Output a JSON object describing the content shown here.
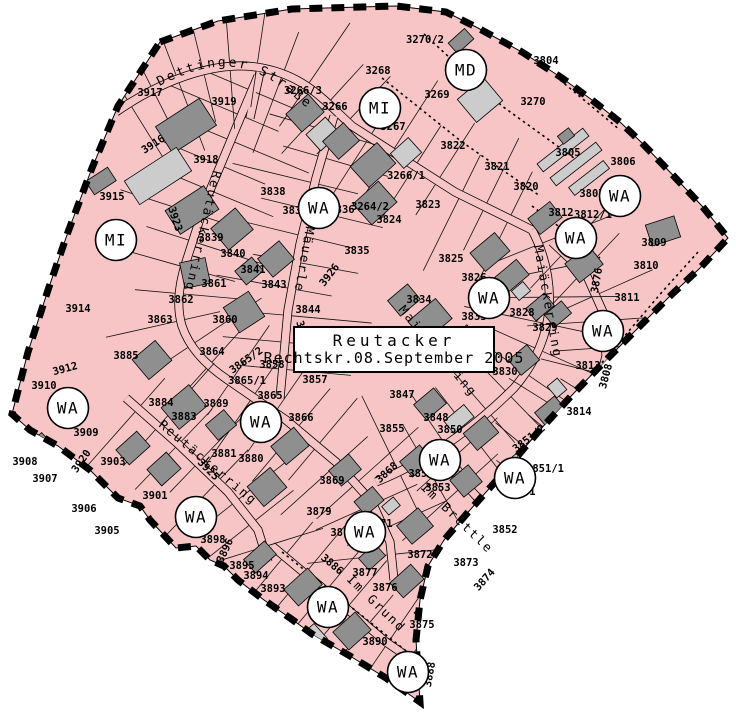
{
  "map": {
    "width": 736,
    "height": 724,
    "kind": "zoning-plan"
  },
  "colors": {
    "zone_pink": "#f7c5c5",
    "building_dark": "#8f8f8f",
    "building_light": "#cccccc",
    "line": "#000000",
    "background": "#ffffff",
    "circle_fill": "#ffffff"
  },
  "title_box": {
    "line1": "Reutacker",
    "line2": "Rechtskr.08.September  2005"
  },
  "boundary": [
    [
      160,
      42
    ],
    [
      218,
      21
    ],
    [
      292,
      9
    ],
    [
      396,
      6
    ],
    [
      446,
      12
    ],
    [
      478,
      28
    ],
    [
      522,
      52
    ],
    [
      562,
      78
    ],
    [
      592,
      100
    ],
    [
      620,
      122
    ],
    [
      642,
      143
    ],
    [
      668,
      170
    ],
    [
      702,
      206
    ],
    [
      728,
      238
    ],
    [
      700,
      268
    ],
    [
      668,
      298
    ],
    [
      640,
      326
    ],
    [
      610,
      356
    ],
    [
      574,
      393
    ],
    [
      538,
      432
    ],
    [
      504,
      472
    ],
    [
      470,
      510
    ],
    [
      444,
      540
    ],
    [
      428,
      566
    ],
    [
      420,
      600
    ],
    [
      416,
      640
    ],
    [
      420,
      702
    ],
    [
      386,
      678
    ],
    [
      350,
      656
    ],
    [
      312,
      634
    ],
    [
      290,
      618
    ],
    [
      264,
      600
    ],
    [
      238,
      580
    ],
    [
      224,
      566
    ],
    [
      210,
      560
    ],
    [
      196,
      546
    ],
    [
      176,
      548
    ],
    [
      150,
      520
    ],
    [
      140,
      506
    ],
    [
      118,
      498
    ],
    [
      90,
      470
    ],
    [
      58,
      446
    ],
    [
      30,
      430
    ],
    [
      12,
      414
    ],
    [
      28,
      352
    ],
    [
      48,
      290
    ],
    [
      68,
      232
    ],
    [
      92,
      168
    ],
    [
      118,
      106
    ]
  ],
  "roads": [
    {
      "id": "dettinger-strasse",
      "d": "M116,112 C168,76 222,60 262,68 C304,76 322,98 352,126 L455,192 L532,230",
      "ticks": true
    },
    {
      "id": "reutaeckerring-upper",
      "d": "M258,76 L236,128 L206,200 L186,262 Q174,300 182,326 Q192,356 228,380 L286,420 L336,462 L372,502 L390,542 L394,580",
      "ticks": true
    },
    {
      "id": "reutaeckerring-lower",
      "d": "M126,398 L178,444 L228,492 L258,530 L268,562",
      "ticks": true
    },
    {
      "id": "maiaeckerring",
      "d": "M532,230 Q552,268 549,310 Q545,352 514,388 Q478,424 438,450 Q406,470 376,482",
      "ticks": true
    },
    {
      "id": "im-maeuerle",
      "d": "M334,116 L316,178 L300,244 L288,310 L280,398",
      "ticks": true
    },
    {
      "id": "im-brettle",
      "d": "M436,452 L476,496 L514,540 L540,566",
      "ticks": true
    },
    {
      "id": "im-grund",
      "d": "M272,546 Q330,594 386,642 L430,672",
      "ticks": true
    },
    {
      "id": "east-lane",
      "d": "M552,242 L586,274 L603,312 L606,356 L595,400 L570,440 L542,474 L522,500",
      "ticks": true
    },
    {
      "id": "north-spur",
      "d": "M260,72 L250,118",
      "ticks": false
    }
  ],
  "dotted_lines": [
    "M382,78 L462,142 L540,196",
    "M424,34 L502,106 L574,158",
    "M532,206 L600,258",
    "M698,252 L662,292 L560,412 L434,574 L424,640",
    "M282,552 L420,662",
    "M560,80 L620,130"
  ],
  "street_labels": {
    "curved": {
      "text": "Dettinger Straße",
      "path": "M156,88 C215,56 252,58 302,104 L336,128",
      "size": 13
    },
    "straight": [
      {
        "text": "Reutäckerring",
        "x": 213,
        "y": 170,
        "rot": 103
      },
      {
        "text": "Reutäckerring",
        "x": 158,
        "y": 426,
        "rot": 40
      },
      {
        "text": "Im Mäuerle",
        "x": 311,
        "y": 198,
        "rot": 100
      },
      {
        "text": "Maiäckerring",
        "x": 534,
        "y": 246,
        "rot": 80
      },
      {
        "text": "Maiäckerring",
        "x": 398,
        "y": 310,
        "rot": 50
      },
      {
        "text": "Im Brettle",
        "x": 420,
        "y": 488,
        "rot": 44
      },
      {
        "text": "Im Grund",
        "x": 346,
        "y": 580,
        "rot": 44
      }
    ]
  },
  "zone_circles": [
    {
      "label": "MD",
      "x": 466,
      "y": 70
    },
    {
      "label": "MI",
      "x": 380,
      "y": 108
    },
    {
      "label": "MI",
      "x": 116,
      "y": 240
    },
    {
      "label": "WA",
      "x": 319,
      "y": 208
    },
    {
      "label": "WA",
      "x": 620,
      "y": 196
    },
    {
      "label": "WA",
      "x": 576,
      "y": 238
    },
    {
      "label": "WA",
      "x": 489,
      "y": 298
    },
    {
      "label": "WA",
      "x": 603,
      "y": 331
    },
    {
      "label": "WA",
      "x": 68,
      "y": 408
    },
    {
      "label": "WA",
      "x": 261,
      "y": 422
    },
    {
      "label": "WA",
      "x": 440,
      "y": 460
    },
    {
      "label": "WA",
      "x": 515,
      "y": 478
    },
    {
      "label": "WA",
      "x": 196,
      "y": 517
    },
    {
      "label": "WA",
      "x": 365,
      "y": 532
    },
    {
      "label": "WA",
      "x": 328,
      "y": 607
    },
    {
      "label": "WA",
      "x": 408,
      "y": 672
    }
  ],
  "parcel_labels": [
    [
      "3917",
      150,
      96,
      0
    ],
    [
      "3919",
      224,
      105,
      0
    ],
    [
      "3916",
      155,
      147,
      -33
    ],
    [
      "3918",
      206,
      163,
      0
    ],
    [
      "3915",
      112,
      200,
      0
    ],
    [
      "3914",
      78,
      312,
      0
    ],
    [
      "3266/3",
      303,
      94,
      0
    ],
    [
      "3266",
      335,
      110,
      0
    ],
    [
      "3268",
      378,
      74,
      0
    ],
    [
      "3267",
      393,
      130,
      0
    ],
    [
      "3270/2",
      425,
      43,
      0
    ],
    [
      "3269",
      437,
      98,
      0
    ],
    [
      "3804",
      546,
      64,
      0
    ],
    [
      "3270",
      533,
      105,
      0
    ],
    [
      "3805",
      568,
      156,
      0
    ],
    [
      "3806",
      623,
      165,
      0
    ],
    [
      "3822",
      453,
      149,
      0
    ],
    [
      "3821",
      497,
      170,
      0
    ],
    [
      "3820",
      526,
      190,
      0
    ],
    [
      "3807",
      592,
      197,
      0
    ],
    [
      "3812",
      561,
      216,
      0
    ],
    [
      "3812/1",
      593,
      218,
      0
    ],
    [
      "3823",
      428,
      208,
      0
    ],
    [
      "3266/1",
      406,
      179,
      0
    ],
    [
      "3264/2",
      370,
      210,
      0
    ],
    [
      "3836",
      342,
      213,
      0
    ],
    [
      "3837",
      295,
      214,
      0
    ],
    [
      "3838",
      273,
      195,
      0
    ],
    [
      "3824",
      389,
      223,
      0
    ],
    [
      "3835",
      357,
      254,
      0
    ],
    [
      "3926",
      332,
      277,
      -52
    ],
    [
      "3825",
      451,
      262,
      0
    ],
    [
      "3826",
      474,
      281,
      0
    ],
    [
      "3834",
      419,
      303,
      0
    ],
    [
      "3833",
      474,
      320,
      0
    ],
    [
      "3828",
      522,
      316,
      0
    ],
    [
      "3829",
      545,
      331,
      0
    ],
    [
      "3830",
      505,
      375,
      0
    ],
    [
      "3876",
      600,
      281,
      -80
    ],
    [
      "3808",
      609,
      377,
      -75
    ],
    [
      "3811",
      627,
      301,
      0
    ],
    [
      "3810",
      646,
      269,
      0
    ],
    [
      "3809",
      654,
      246,
      0
    ],
    [
      "3813",
      588,
      369,
      0
    ],
    [
      "3814",
      579,
      415,
      0
    ],
    [
      "3839",
      211,
      241,
      0
    ],
    [
      "3840",
      233,
      257,
      0
    ],
    [
      "3841",
      253,
      273,
      0
    ],
    [
      "3843",
      274,
      288,
      0
    ],
    [
      "3844",
      308,
      313,
      0
    ],
    [
      "3861",
      214,
      287,
      0
    ],
    [
      "3862",
      181,
      303,
      0
    ],
    [
      "3863",
      160,
      323,
      0
    ],
    [
      "3860",
      225,
      323,
      0
    ],
    [
      "3885",
      126,
      359,
      0
    ],
    [
      "3864",
      212,
      355,
      0
    ],
    [
      "3865/2",
      248,
      363,
      -35
    ],
    [
      "3865/1",
      247,
      384,
      0
    ],
    [
      "3865",
      270,
      399,
      0
    ],
    [
      "3858",
      272,
      368,
      0
    ],
    [
      "3857",
      315,
      383,
      0
    ],
    [
      "3866",
      301,
      421,
      0
    ],
    [
      "3867",
      300,
      334,
      72
    ],
    [
      "3889",
      216,
      407,
      0
    ],
    [
      "3884",
      161,
      406,
      0
    ],
    [
      "3883",
      184,
      420,
      0
    ],
    [
      "3881",
      224,
      457,
      0
    ],
    [
      "3880",
      251,
      462,
      0
    ],
    [
      "3869",
      332,
      484,
      0
    ],
    [
      "3879",
      319,
      515,
      0
    ],
    [
      "3870",
      343,
      536,
      0
    ],
    [
      "3871",
      380,
      527,
      0
    ],
    [
      "3868",
      389,
      475,
      -42
    ],
    [
      "3855",
      392,
      432,
      0
    ],
    [
      "3847",
      402,
      398,
      0
    ],
    [
      "3848",
      436,
      421,
      0
    ],
    [
      "3850",
      450,
      433,
      0
    ],
    [
      "3854",
      421,
      477,
      0
    ],
    [
      "3853",
      438,
      491,
      0
    ],
    [
      "3851/1",
      545,
      472,
      0
    ],
    [
      "3851",
      523,
      495,
      0
    ],
    [
      "3851/2",
      531,
      441,
      -38
    ],
    [
      "3852",
      505,
      533,
      0
    ],
    [
      "3873",
      466,
      566,
      0
    ],
    [
      "3872",
      420,
      558,
      0
    ],
    [
      "3874",
      487,
      582,
      -48
    ],
    [
      "3875",
      422,
      628,
      0
    ],
    [
      "3876",
      385,
      591,
      0
    ],
    [
      "3877",
      365,
      576,
      0
    ],
    [
      "3890",
      375,
      645,
      0
    ],
    [
      "3888",
      433,
      675,
      -80
    ],
    [
      "3886",
      330,
      567,
      40
    ],
    [
      "3893",
      273,
      592,
      0
    ],
    [
      "3894",
      256,
      579,
      0
    ],
    [
      "3895",
      242,
      569,
      0
    ],
    [
      "3896",
      228,
      552,
      -65
    ],
    [
      "3898",
      213,
      543,
      0
    ],
    [
      "3901",
      155,
      499,
      0
    ],
    [
      "3903",
      113,
      465,
      0
    ],
    [
      "3905",
      107,
      534,
      0
    ],
    [
      "3906",
      84,
      512,
      0
    ],
    [
      "3907",
      45,
      482,
      0
    ],
    [
      "3908",
      25,
      465,
      0
    ],
    [
      "3909",
      86,
      436,
      0
    ],
    [
      "3910",
      44,
      389,
      0
    ],
    [
      "3912",
      66,
      372,
      -15
    ],
    [
      "3920",
      84,
      463,
      -55
    ],
    [
      "3923",
      172,
      220,
      72
    ],
    [
      "3925",
      206,
      472,
      45
    ]
  ],
  "buildings": [
    [
      186,
      126,
      52,
      32,
      -33,
      "d"
    ],
    [
      158,
      176,
      62,
      28,
      -33,
      "l"
    ],
    [
      192,
      210,
      46,
      28,
      -33,
      "d"
    ],
    [
      101,
      181,
      26,
      16,
      -33,
      "d"
    ],
    [
      305,
      113,
      30,
      24,
      -42,
      "d"
    ],
    [
      323,
      134,
      26,
      22,
      -42,
      "l"
    ],
    [
      341,
      141,
      28,
      24,
      -42,
      "d"
    ],
    [
      373,
      165,
      36,
      28,
      -42,
      "d"
    ],
    [
      375,
      203,
      34,
      28,
      -42,
      "d"
    ],
    [
      406,
      153,
      24,
      20,
      -42,
      "l"
    ],
    [
      461,
      41,
      22,
      14,
      -42,
      "d"
    ],
    [
      480,
      100,
      34,
      30,
      -40,
      "l"
    ],
    [
      508,
      22,
      16,
      12,
      -40,
      "d"
    ],
    [
      563,
      150,
      58,
      10,
      -38,
      "l"
    ],
    [
      576,
      164,
      58,
      10,
      -38,
      "l"
    ],
    [
      589,
      178,
      44,
      10,
      -38,
      "l"
    ],
    [
      566,
      136,
      14,
      10,
      -38,
      "d"
    ],
    [
      545,
      218,
      28,
      20,
      -38,
      "d"
    ],
    [
      584,
      264,
      30,
      24,
      -38,
      "d"
    ],
    [
      663,
      231,
      30,
      22,
      -18,
      "d"
    ],
    [
      490,
      252,
      32,
      24,
      -40,
      "d"
    ],
    [
      512,
      276,
      28,
      20,
      -40,
      "d"
    ],
    [
      540,
      307,
      24,
      16,
      -40,
      "d"
    ],
    [
      558,
      314,
      22,
      16,
      -40,
      "d"
    ],
    [
      521,
      291,
      15,
      12,
      -40,
      "l"
    ],
    [
      524,
      360,
      24,
      20,
      -40,
      "d"
    ],
    [
      551,
      412,
      26,
      20,
      -40,
      "d"
    ],
    [
      557,
      388,
      13,
      15,
      -40,
      "l"
    ],
    [
      430,
      320,
      36,
      26,
      -40,
      "d"
    ],
    [
      404,
      300,
      26,
      20,
      -40,
      "d"
    ],
    [
      464,
      337,
      20,
      15,
      -40,
      "l"
    ],
    [
      232,
      229,
      32,
      28,
      -40,
      "d"
    ],
    [
      276,
      259,
      28,
      24,
      -40,
      "d"
    ],
    [
      249,
      271,
      22,
      18,
      -40,
      "d"
    ],
    [
      195,
      273,
      26,
      26,
      -12,
      "d"
    ],
    [
      152,
      360,
      30,
      26,
      -40,
      "d"
    ],
    [
      244,
      312,
      30,
      30,
      -33,
      "d"
    ],
    [
      184,
      407,
      36,
      28,
      -40,
      "d"
    ],
    [
      221,
      425,
      24,
      20,
      -40,
      "d"
    ],
    [
      290,
      446,
      30,
      24,
      -40,
      "d"
    ],
    [
      267,
      487,
      30,
      26,
      -40,
      "d"
    ],
    [
      345,
      470,
      26,
      20,
      -40,
      "d"
    ],
    [
      416,
      461,
      26,
      20,
      -40,
      "d"
    ],
    [
      430,
      404,
      26,
      20,
      -40,
      "d"
    ],
    [
      459,
      419,
      26,
      16,
      -40,
      "l"
    ],
    [
      481,
      433,
      28,
      22,
      -40,
      "d"
    ],
    [
      466,
      481,
      24,
      22,
      -40,
      "d"
    ],
    [
      521,
      458,
      28,
      13,
      -40,
      "l"
    ],
    [
      496,
      522,
      32,
      26,
      -40,
      "d"
    ],
    [
      415,
      526,
      28,
      24,
      -40,
      "d"
    ],
    [
      369,
      501,
      24,
      18,
      -40,
      "d"
    ],
    [
      391,
      506,
      15,
      11,
      -40,
      "l"
    ],
    [
      38,
      448,
      26,
      18,
      -42,
      "d"
    ],
    [
      72,
      483,
      28,
      22,
      -42,
      "d"
    ],
    [
      133,
      448,
      28,
      20,
      -42,
      "d"
    ],
    [
      164,
      469,
      26,
      22,
      -42,
      "d"
    ],
    [
      79,
      506,
      28,
      22,
      -42,
      "d"
    ],
    [
      111,
      518,
      28,
      20,
      -42,
      "d"
    ],
    [
      260,
      557,
      28,
      18,
      -42,
      "d"
    ],
    [
      303,
      587,
      32,
      22,
      -42,
      "d"
    ],
    [
      372,
      557,
      22,
      16,
      -42,
      "d"
    ],
    [
      407,
      581,
      28,
      20,
      -42,
      "d"
    ],
    [
      352,
      631,
      30,
      24,
      -42,
      "d"
    ],
    [
      434,
      611,
      32,
      24,
      -42,
      "d"
    ],
    [
      314,
      637,
      18,
      20,
      -42,
      "l"
    ]
  ]
}
